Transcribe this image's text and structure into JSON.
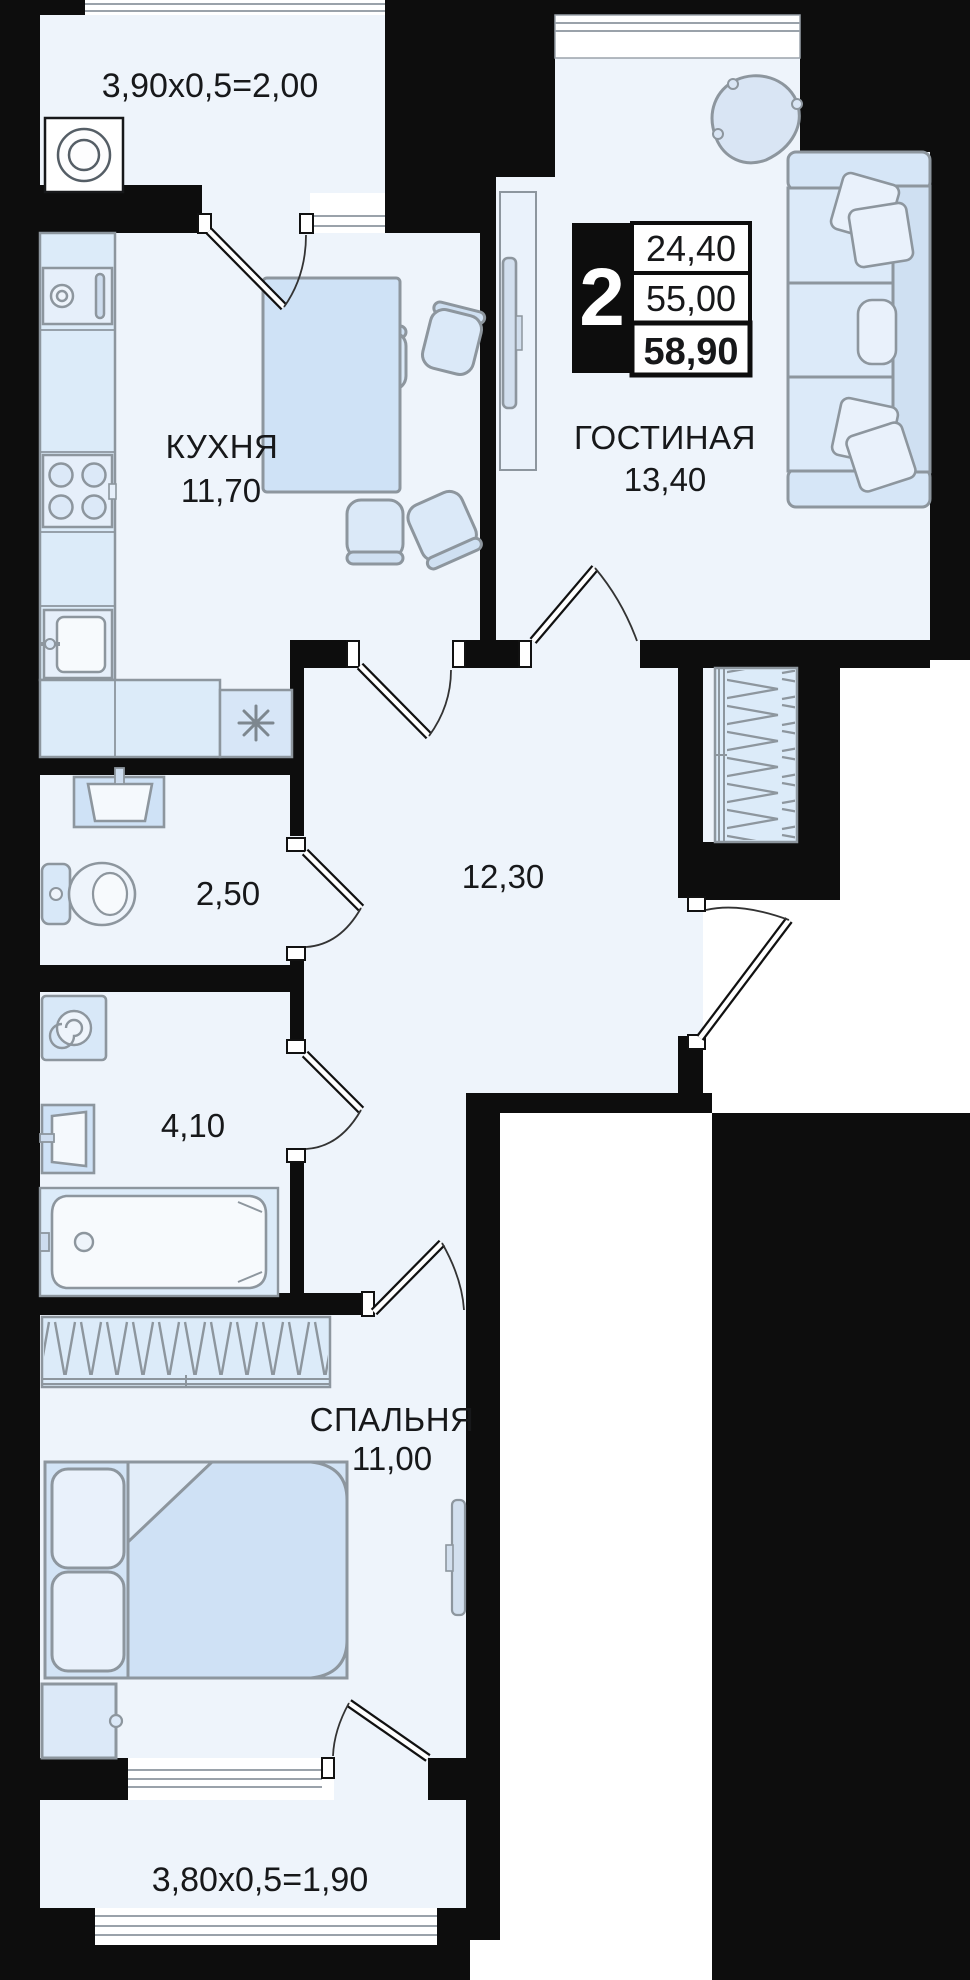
{
  "plan": {
    "area_table": {
      "rooms_count": "2",
      "living_area": "24,40",
      "apartment_area": "55,00",
      "total_area": "58,90"
    },
    "rooms": {
      "balcony_top": {
        "label": "3,90x0,5=2,00"
      },
      "kitchen": {
        "name": "КУХНЯ",
        "area": "11,70"
      },
      "living_room": {
        "name": "ГОСТИНАЯ",
        "area": "13,40"
      },
      "hallway": {
        "area": "12,30"
      },
      "wc": {
        "area": "2,50"
      },
      "bathroom": {
        "area": "4,10"
      },
      "bedroom": {
        "name": "СПАЛЬНЯ",
        "area": "11,00"
      },
      "balcony_bottom": {
        "label": "3,80x0,5=1,90"
      }
    },
    "colors": {
      "wall": "#0d0d0d",
      "room_fill": "#eef4fb",
      "furniture_fill": "#d6e6f7",
      "furniture_light": "#e9f1fb",
      "stroke": "#8d969e",
      "outside": "#ffffff"
    }
  }
}
